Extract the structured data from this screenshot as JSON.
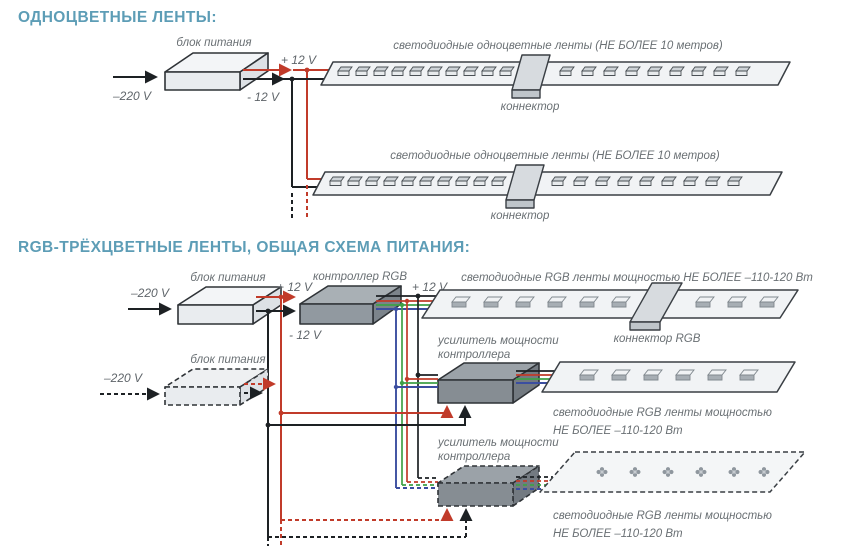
{
  "colors": {
    "accent_teal": "#5d9db6",
    "label_gray": "#6a7074",
    "wire_black": "#1d2124",
    "wire_red": "#c13b2a",
    "wire_green": "#3fa047",
    "wire_blue": "#3b4ea0",
    "box_light": "#e9ecef",
    "box_dark": "#9199a0"
  },
  "section1": {
    "title": "ОДНОЦВЕТНЫЕ ЛЕНТЫ:",
    "psu_label": "блок питания",
    "input_label": "–220 V",
    "plus_label": "+ 12 V",
    "minus_label": "- 12 V",
    "strip_label": "светодиодные одноцветные ленты (НЕ БОЛЕЕ 10 метров)",
    "connector_label": "коннектор"
  },
  "section2": {
    "title": "RGB-ТРЁХЦВЕТНЫЕ ЛЕНТЫ, ОБЩАЯ СХЕМА ПИТАНИЯ:",
    "psu_label": "блок питания",
    "input_label": "–220 V",
    "plus_label": "+ 12 V",
    "minus_label": "- 12 V",
    "controller_label": "контроллер RGB",
    "strip_top_label": "светодиодные RGB ленты мощностью НЕ БОЛЕЕ –110-120 Вт",
    "connector_label": "коннектор RGB",
    "amp_label_line1": "усилитель мощности",
    "amp_label_line2": "контроллера",
    "strip_power_line1": "светодиодные RGB ленты мощностью",
    "strip_power_line2": "НЕ БОЛЕЕ –110-120 Вт"
  }
}
